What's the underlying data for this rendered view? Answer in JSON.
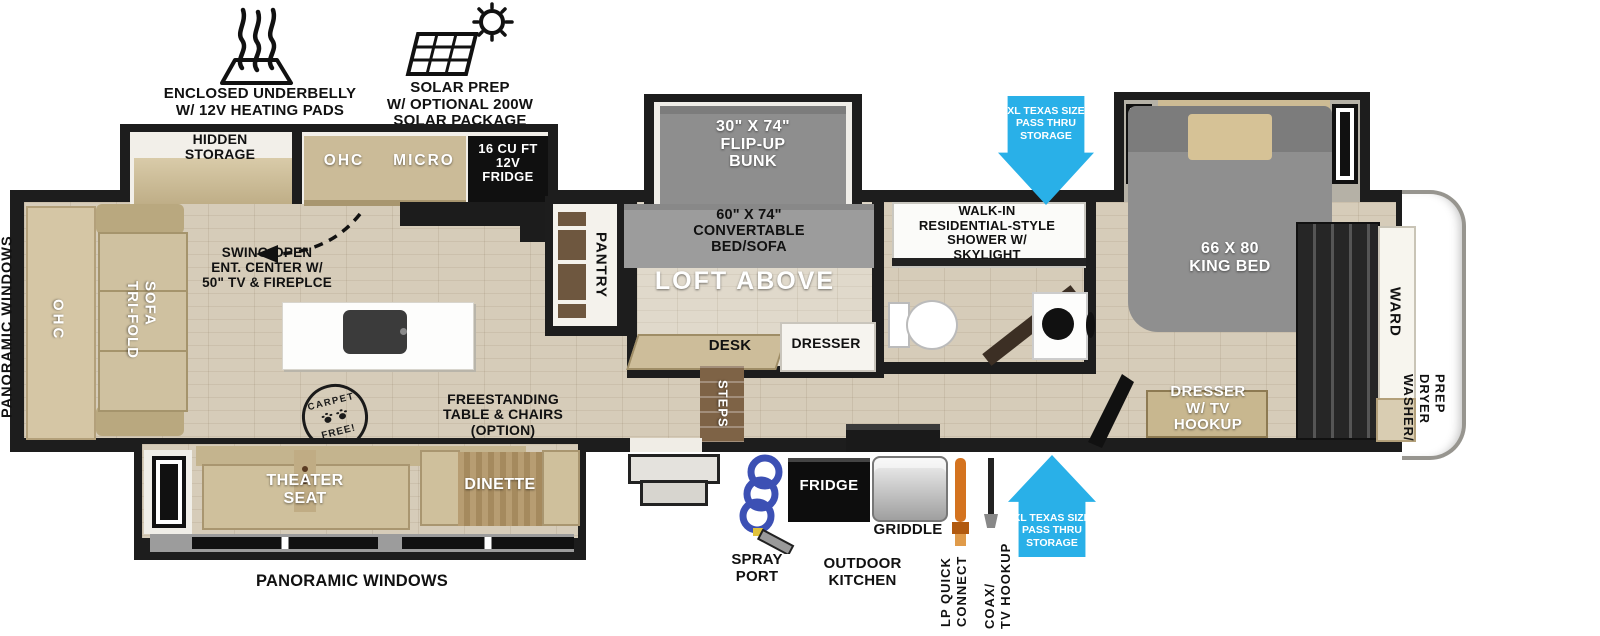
{
  "colors": {
    "wall": "#1d1d1d",
    "floor_tan": "#d6ccb9",
    "cabinet_tan": "#cdbd9a",
    "mattress_gray": "#8f8f8f",
    "accent_blue": "#29b0e8",
    "lp_orange": "#d4731f",
    "hose_blue": "#3c50b4"
  },
  "legend": {
    "underbelly": {
      "label": "ENCLOSED UNDERBELLY\nW/ 12V HEATING PADS"
    },
    "solar": {
      "label": "SOLAR PREP\nW/ OPTIONAL 200W\nSOLAR PACKAGE"
    }
  },
  "callouts": {
    "pass_thru_top": "XL TEXAS SIZE\nPASS THRU\nSTORAGE",
    "pass_thru_bottom": "XL TEXAS SIZE\nPASS THRU\nSTORAGE",
    "panoramic_left": "PANORAMIC WINDOWS",
    "panoramic_bottom": "PANORAMIC WINDOWS",
    "spray_port": "SPRAY\nPORT",
    "outdoor_kitchen": "OUTDOOR\nKITCHEN",
    "griddle": "GRIDDLE",
    "outdoor_fridge": "FRIDGE",
    "lp_quick_connect": "LP QUICK\nCONNECT",
    "coax_tv": "COAX/\nTV HOOKUP"
  },
  "rooms": {
    "hidden_storage": "HIDDEN\nSTORAGE",
    "ohc_rear": "OHC",
    "trifold_sofa": "TRI-FOLD\nSOFA",
    "swing_open": "SWING-OPEN\nENT. CENTER W/\n50\" TV & FIREPLCE",
    "ohc_kitchen": "OHC",
    "micro": "MICRO",
    "fridge_12v": "16 CU FT\n12V\nFRIDGE",
    "pantry": "PANTRY",
    "carpet_free_top": "CARPET",
    "carpet_free_bottom": "FREE!",
    "freestanding": "FREESTANDING\nTABLE & CHAIRS\n(OPTION)",
    "theater_seat": "THEATER\nSEAT",
    "dinette": "DINETTE",
    "flip_up_bunk": "30\" X 74\"\nFLIP-UP\nBUNK",
    "convertable": "60\" X 74\"\nCONVERTABLE\nBED/SOFA",
    "loft_above": "LOFT ABOVE",
    "desk": "DESK",
    "dresser": "DRESSER",
    "steps": "STEPS",
    "shower": "WALK-IN\nRESIDENTIAL-STYLE\nSHOWER W/\nSKYLIGHT",
    "king_bed": "66 X 80\nKING BED",
    "dresser_tv": "DRESSER\nW/ TV\nHOOKUP",
    "ward": "WARD",
    "washer_dryer": "WASHER/\nDRYER\nPREP"
  }
}
